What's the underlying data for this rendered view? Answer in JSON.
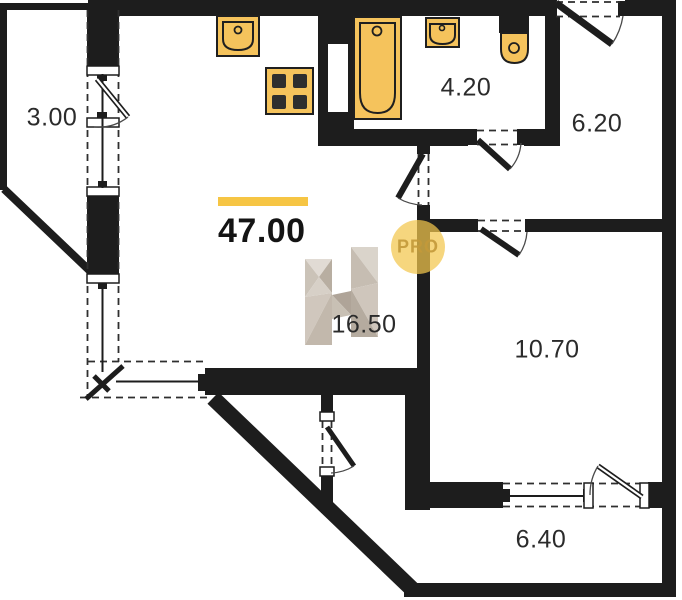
{
  "theme": {
    "accent_yellow": "#F6C544",
    "wall_color": "#1d1d1d",
    "fixture_fill": "#F5C35C",
    "fixture_stroke": "#1f1f1f",
    "burner_color": "#2e2e2e",
    "pro_circle_fill": "rgba(242,198,76,0.72)",
    "pro_text_color": "#C49A3A",
    "label_color": "#2b2b2b",
    "dash_color": "#2f2f2f"
  },
  "total_area": {
    "value": "47.00"
  },
  "rooms": [
    {
      "name": "balcony-top",
      "area": "3.00"
    },
    {
      "name": "bathroom",
      "area": "4.20"
    },
    {
      "name": "hallway",
      "area": "6.20"
    },
    {
      "name": "living-room",
      "area": "16.50"
    },
    {
      "name": "bedroom",
      "area": "10.70"
    },
    {
      "name": "balcony-bottom",
      "area": "6.40"
    }
  ],
  "watermark": {
    "pro_label": "PRO",
    "logo": "h-facet-logo"
  },
  "fixtures": [
    {
      "name": "kitchen-sink"
    },
    {
      "name": "stove"
    },
    {
      "name": "bathtub"
    },
    {
      "name": "washbasin"
    },
    {
      "name": "toilet"
    }
  ]
}
